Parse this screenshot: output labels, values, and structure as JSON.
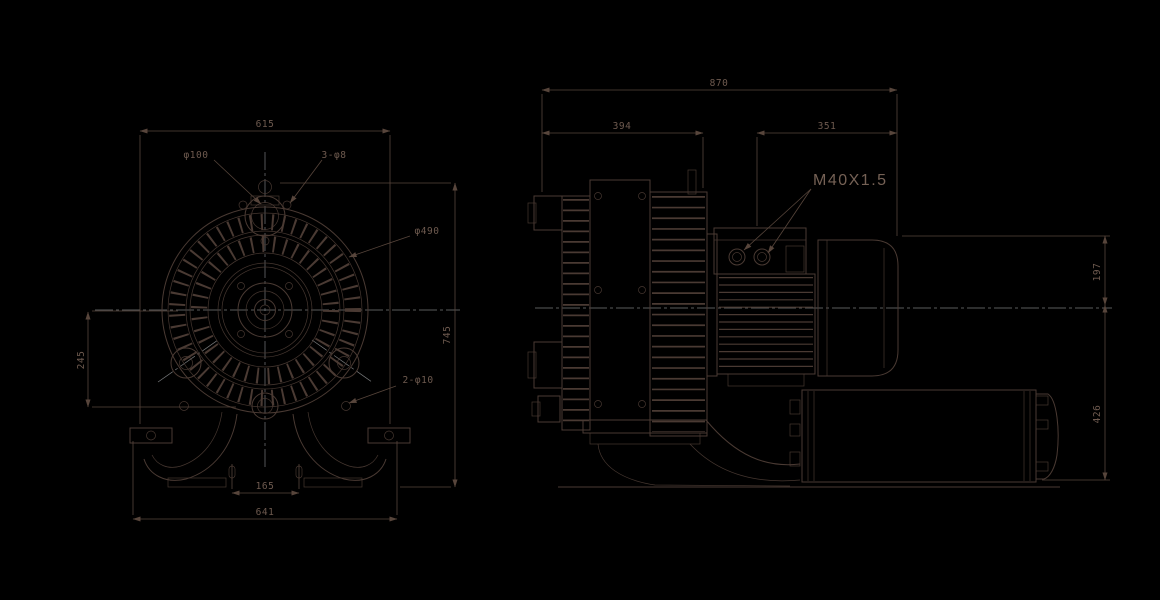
{
  "colors": {
    "background": "#000000",
    "line": "#4a3a33",
    "dim": "#57453b",
    "text": "#6e5a4f",
    "text2": "#756155",
    "centerline": "#96999b"
  },
  "front_view": {
    "dims": {
      "top_width": "615",
      "inlet_diameter": "φ100",
      "inlet_bolt_holes": "3-φ8",
      "impeller_diameter": "φ490",
      "mount_holes": "2-φ10",
      "center_to_base": "245",
      "overall_height": "745",
      "foot_hole_spacing": "165",
      "overall_width": "641"
    }
  },
  "side_view": {
    "dims": {
      "overall_length": "870",
      "pump_section_length": "394",
      "motor_section_length": "351",
      "center_to_top": "197",
      "center_to_bottom": "426"
    },
    "labels": {
      "cable_gland_thread": "M40X1.5"
    }
  }
}
